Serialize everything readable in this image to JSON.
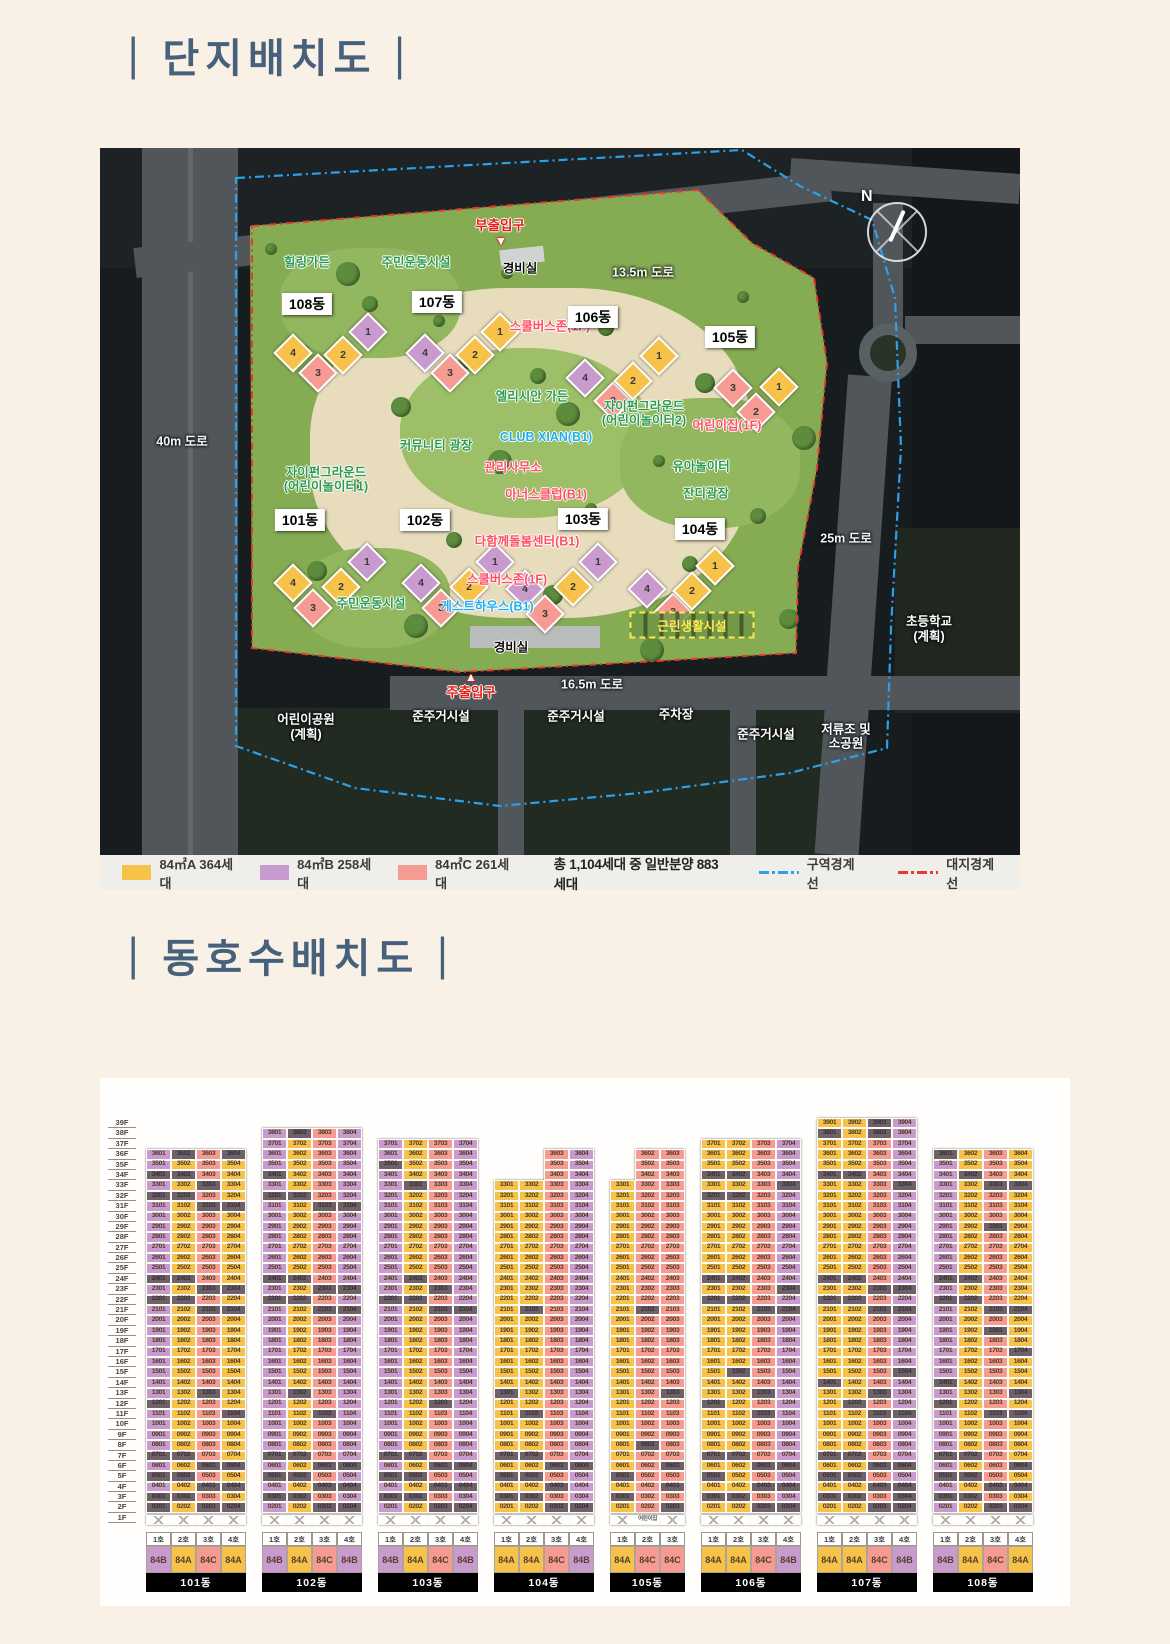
{
  "sections": {
    "bar": "|",
    "site_plan_title": "단지배치도",
    "unit_layout_title": "동호수배치도"
  },
  "compass": {
    "n": "N"
  },
  "colors": {
    "84A": "#f6c24a",
    "84B": "#c99ace",
    "84C": "#f59b91",
    "gray_cell": "#6e6167",
    "boundary_zone": "#2ba1ea",
    "boundary_site": "#e8382f"
  },
  "site_plan": {
    "legend": {
      "type_items": [
        {
          "type": "84A",
          "label": "84㎡A 364세대"
        },
        {
          "type": "84B",
          "label": "84㎡B 258세대"
        },
        {
          "type": "84C",
          "label": "84㎡C 261세대"
        }
      ],
      "total_label": "총 1,104세대 중 일반분양 883세대",
      "boundary_items": [
        {
          "key": "boundary_zone",
          "label": "구역경계선"
        },
        {
          "key": "boundary_site",
          "label": "대지경계선"
        }
      ]
    },
    "labels": [
      {
        "t": "부출입구",
        "cat": "red",
        "x": 400,
        "y": 76
      },
      {
        "t": "경비실",
        "cat": "dark",
        "x": 420,
        "y": 119
      },
      {
        "t": "13.5m 도로",
        "cat": "road-t",
        "x": 543,
        "y": 123
      },
      {
        "t": "힐링가든",
        "cat": "green",
        "x": 207,
        "y": 113
      },
      {
        "t": "주민운동시설",
        "cat": "green",
        "x": 316,
        "y": 113
      },
      {
        "t": "스쿨버스존(1F)",
        "cat": "pink",
        "x": 450,
        "y": 177
      },
      {
        "t": "엘리시안 가든",
        "cat": "green",
        "x": 432,
        "y": 247
      },
      {
        "t": "자이펀그라운드",
        "cat": "green",
        "x": 544,
        "y": 257
      },
      {
        "t": "(어린이놀이터2)",
        "cat": "green",
        "x": 544,
        "y": 271
      },
      {
        "t": "어린이집(1F)",
        "cat": "pink",
        "x": 627,
        "y": 276
      },
      {
        "t": "CLUB XIAN(B1)",
        "cat": "blue",
        "x": 446,
        "y": 289
      },
      {
        "t": "커뮤니티 광장",
        "cat": "green",
        "x": 336,
        "y": 296
      },
      {
        "t": "관리사무소",
        "cat": "pink",
        "x": 413,
        "y": 318
      },
      {
        "t": "유아놀이터",
        "cat": "green",
        "x": 601,
        "y": 317
      },
      {
        "t": "자이펀그라운드",
        "cat": "green",
        "x": 226,
        "y": 323
      },
      {
        "t": "(어린이놀이터1)",
        "cat": "green",
        "x": 226,
        "y": 337
      },
      {
        "t": "아너스클럽(B1)",
        "cat": "pink",
        "x": 446,
        "y": 345
      },
      {
        "t": "잔디광장",
        "cat": "green",
        "x": 606,
        "y": 344
      },
      {
        "t": "다함께돌봄센터(B1)",
        "cat": "pink",
        "x": 427,
        "y": 392
      },
      {
        "t": "25m 도로",
        "cat": "road-t",
        "x": 746,
        "y": 389
      },
      {
        "t": "40m 도로",
        "cat": "road-t",
        "x": 82,
        "y": 292
      },
      {
        "t": "주민운동시설",
        "cat": "green",
        "x": 271,
        "y": 454
      },
      {
        "t": "스쿨버스존(1F)",
        "cat": "pink",
        "x": 407,
        "y": 430
      },
      {
        "t": "게스트하우스(B1)",
        "cat": "blue",
        "x": 387,
        "y": 457
      },
      {
        "t": "경비실",
        "cat": "dark",
        "x": 411,
        "y": 498
      },
      {
        "t": "근린생활시설",
        "cat": "yellowbox",
        "x": 592,
        "y": 477
      },
      {
        "t": "주출입구",
        "cat": "red",
        "x": 371,
        "y": 543
      },
      {
        "t": "16.5m 도로",
        "cat": "road-t",
        "x": 492,
        "y": 535
      },
      {
        "t": "어린이공원",
        "cat": "white",
        "x": 206,
        "y": 570
      },
      {
        "t": "(계획)",
        "cat": "white",
        "x": 206,
        "y": 585
      },
      {
        "t": "준주거시설",
        "cat": "white",
        "x": 341,
        "y": 567
      },
      {
        "t": "준주거시설",
        "cat": "white",
        "x": 476,
        "y": 567
      },
      {
        "t": "주차장",
        "cat": "white",
        "x": 576,
        "y": 565
      },
      {
        "t": "준주거시설",
        "cat": "white",
        "x": 666,
        "y": 585
      },
      {
        "t": "저류조 및",
        "cat": "white",
        "x": 746,
        "y": 580
      },
      {
        "t": "소공원",
        "cat": "white",
        "x": 746,
        "y": 594
      },
      {
        "t": "초등학교",
        "cat": "white",
        "x": 829,
        "y": 472
      },
      {
        "t": "(계획)",
        "cat": "white",
        "x": 829,
        "y": 487
      }
    ],
    "entrance_markers": [
      {
        "x": 401,
        "y": 93,
        "dir": "down"
      },
      {
        "x": 371,
        "y": 529,
        "dir": "up"
      }
    ],
    "clusters": [
      {
        "name": "101동",
        "label": [
          200,
          372
        ],
        "units": [
          [
            4,
            193,
            435
          ],
          [
            3,
            213,
            460
          ],
          [
            2,
            241,
            439
          ],
          [
            1,
            267,
            414
          ]
        ]
      },
      {
        "name": "102동",
        "label": [
          325,
          372
        ],
        "units": [
          [
            4,
            321,
            435
          ],
          [
            3,
            341,
            460
          ],
          [
            2,
            369,
            439
          ],
          [
            1,
            395,
            414
          ]
        ]
      },
      {
        "name": "103동",
        "label": [
          483,
          371
        ],
        "units": [
          [
            4,
            425,
            441
          ],
          [
            3,
            445,
            466
          ],
          [
            2,
            473,
            439
          ],
          [
            1,
            498,
            414
          ]
        ]
      },
      {
        "name": "104동",
        "label": [
          600,
          381
        ],
        "units": [
          [
            4,
            547,
            441
          ],
          [
            3,
            573,
            464
          ],
          [
            2,
            592,
            443
          ],
          [
            1,
            615,
            418
          ]
        ]
      },
      {
        "name": "105동",
        "label": [
          630,
          189
        ],
        "units": [
          [
            3,
            633,
            240
          ],
          [
            2,
            656,
            264
          ],
          [
            1,
            679,
            239
          ]
        ]
      },
      {
        "name": "106동",
        "label": [
          493,
          169
        ],
        "units": [
          [
            4,
            485,
            230
          ],
          [
            3,
            513,
            253
          ],
          [
            2,
            533,
            233
          ],
          [
            1,
            559,
            208
          ]
        ]
      },
      {
        "name": "107동",
        "label": [
          337,
          154
        ],
        "units": [
          [
            4,
            325,
            205
          ],
          [
            3,
            350,
            225
          ],
          [
            2,
            375,
            207
          ],
          [
            1,
            400,
            184
          ]
        ]
      },
      {
        "name": "108동",
        "label": [
          207,
          156
        ],
        "units": [
          [
            4,
            193,
            205
          ],
          [
            3,
            218,
            225
          ],
          [
            2,
            243,
            207
          ],
          [
            1,
            268,
            184
          ]
        ]
      }
    ]
  },
  "unit_grid": {
    "floor_labels": [
      "39F",
      "38F",
      "37F",
      "36F",
      "35F",
      "34F",
      "33F",
      "32F",
      "31F",
      "30F",
      "29F",
      "28F",
      "27F",
      "26F",
      "25F",
      "24F",
      "23F",
      "22F",
      "21F",
      "20F",
      "19F",
      "18F",
      "17F",
      "16F",
      "15F",
      "14F",
      "13F",
      "12F",
      "11F",
      "10F",
      "9F",
      "8F",
      "7F",
      "6F",
      "5F",
      "4F",
      "3F",
      "2F",
      "1F"
    ],
    "max_floor": 39,
    "buildings": [
      {
        "name": "101동",
        "cols": [
          "1호",
          "2호",
          "3호",
          "4호"
        ],
        "types": [
          "84B",
          "84A",
          "84C",
          "84A"
        ],
        "tops": [
          36,
          36,
          36,
          36
        ],
        "gray": {
          "36": [
            2,
            4
          ],
          "34": [
            1,
            2
          ],
          "33": [
            3
          ],
          "32": [
            1,
            2
          ],
          "31": [
            3,
            4
          ],
          "24": [
            1,
            2
          ],
          "23": [
            3,
            4
          ],
          "22": [
            1,
            2
          ],
          "21": [
            3,
            4
          ],
          "13": [
            3
          ],
          "12": [
            1
          ],
          "11": [
            4
          ],
          "7": [
            1,
            2
          ],
          "6": [
            3,
            4
          ],
          "5": [
            1,
            2
          ],
          "4": [
            3,
            4
          ],
          "3": [
            1,
            2
          ],
          "2": [
            1,
            3,
            4
          ]
        }
      },
      {
        "name": "102동",
        "cols": [
          "1호",
          "2호",
          "3호",
          "4호"
        ],
        "types": [
          "84B",
          "84A",
          "84C",
          "84B"
        ],
        "tops": [
          38,
          38,
          38,
          38
        ],
        "gray": {
          "38": [
            2
          ],
          "34": [
            1
          ],
          "32": [
            1,
            2
          ],
          "31": [
            3,
            4
          ],
          "24": [
            1,
            2
          ],
          "23": [
            3,
            4
          ],
          "22": [
            1,
            2
          ],
          "21": [
            3,
            4
          ],
          "13": [
            2
          ],
          "11": [
            3
          ],
          "7": [
            1,
            2
          ],
          "6": [
            3,
            4
          ],
          "5": [
            1,
            2
          ],
          "4": [
            3,
            4
          ],
          "3": [
            1,
            2
          ],
          "2": [
            3,
            4
          ]
        }
      },
      {
        "name": "103동",
        "cols": [
          "1호",
          "2호",
          "3호",
          "4호"
        ],
        "types": [
          "84B",
          "84A",
          "84C",
          "84B"
        ],
        "tops": [
          37,
          37,
          37,
          37
        ],
        "gray": {
          "35": [
            1
          ],
          "33": [
            2
          ],
          "24": [
            2
          ],
          "23": [
            3
          ],
          "22": [
            1,
            2
          ],
          "21": [
            3,
            4
          ],
          "12": [
            3
          ],
          "7": [
            1,
            2
          ],
          "6": [
            3,
            4
          ],
          "5": [
            1,
            2
          ],
          "4": [
            3,
            4
          ],
          "3": [
            1,
            2
          ],
          "2": [
            3,
            4
          ]
        }
      },
      {
        "name": "104동",
        "cols": [
          "1호",
          "2호",
          "3호",
          "4호"
        ],
        "types": [
          "84A",
          "84A",
          "84C",
          "84B"
        ],
        "tops": [
          33,
          33,
          36,
          36
        ],
        "gray": {
          "21": [
            2
          ],
          "13": [
            1
          ],
          "11": [
            2
          ],
          "7": [
            1,
            2
          ],
          "6": [
            3,
            4
          ],
          "5": [
            1,
            2
          ],
          "4": [
            3
          ],
          "3": [
            1,
            2
          ],
          "2": [
            3,
            4
          ]
        }
      },
      {
        "name": "105동",
        "cols": [
          "1호",
          "2호",
          "3호"
        ],
        "types": [
          "84A",
          "84C",
          "84C"
        ],
        "tops": [
          33,
          36,
          36
        ],
        "gray": {
          "21": [
            2
          ],
          "13": [
            3
          ],
          "8": [
            2
          ],
          "6": [
            3
          ],
          "5": [
            1
          ],
          "4": [
            3
          ],
          "3": [
            1
          ],
          "2": [
            3
          ]
        },
        "f1": [
          "x",
          "어린이집",
          "x"
        ]
      },
      {
        "name": "106동",
        "cols": [
          "1호",
          "2호",
          "3호",
          "4호"
        ],
        "types": [
          "84A",
          "84A",
          "84C",
          "84B"
        ],
        "tops": [
          37,
          37,
          37,
          37
        ],
        "gray": {
          "34": [
            1,
            2
          ],
          "33": [
            4
          ],
          "32": [
            1,
            2
          ],
          "24": [
            1,
            2
          ],
          "23": [
            4
          ],
          "22": [
            1,
            2
          ],
          "21": [
            3,
            4
          ],
          "15": [
            2
          ],
          "13": [
            3
          ],
          "12": [
            1
          ],
          "11": [
            3
          ],
          "7": [
            1,
            2
          ],
          "6": [
            3,
            4
          ],
          "5": [
            1
          ],
          "4": [
            3,
            4
          ],
          "3": [
            1,
            2
          ],
          "2": [
            3,
            4
          ]
        }
      },
      {
        "name": "107동",
        "cols": [
          "1호",
          "2호",
          "3호",
          "4호"
        ],
        "types": [
          "84A",
          "84A",
          "84C",
          "84B"
        ],
        "tops": [
          39,
          39,
          39,
          39
        ],
        "gray": {
          "39": [
            3
          ],
          "38": [
            1,
            3
          ],
          "34": [
            1,
            2
          ],
          "33": [
            4
          ],
          "24": [
            1,
            2
          ],
          "23": [
            3,
            4
          ],
          "22": [
            1,
            2
          ],
          "21": [
            3,
            4
          ],
          "15": [
            4
          ],
          "14": [
            1
          ],
          "13": [
            3
          ],
          "12": [
            2
          ],
          "11": [
            3,
            4
          ],
          "7": [
            1,
            2
          ],
          "6": [
            3,
            4
          ],
          "5": [
            1,
            2
          ],
          "4": [
            3,
            4
          ],
          "3": [
            1,
            2,
            4
          ],
          "2": [
            3,
            4
          ]
        }
      },
      {
        "name": "108동",
        "cols": [
          "1호",
          "2호",
          "3호",
          "4호"
        ],
        "types": [
          "84B",
          "84A",
          "84C",
          "84A"
        ],
        "tops": [
          36,
          36,
          36,
          36
        ],
        "gray": {
          "36": [
            1
          ],
          "34": [
            2
          ],
          "33": [
            3,
            4
          ],
          "29": [
            3
          ],
          "24": [
            1,
            2
          ],
          "22": [
            1,
            2
          ],
          "21": [
            3,
            4
          ],
          "19": [
            3
          ],
          "17": [
            4
          ],
          "14": [
            1
          ],
          "13": [
            4
          ],
          "12": [
            1
          ],
          "11": [
            3,
            4
          ],
          "7": [
            1,
            2
          ],
          "6": [
            4
          ],
          "5": [
            1,
            2
          ],
          "4": [
            3,
            4
          ],
          "3": [
            1,
            2
          ],
          "2": [
            3,
            4
          ]
        }
      }
    ]
  }
}
